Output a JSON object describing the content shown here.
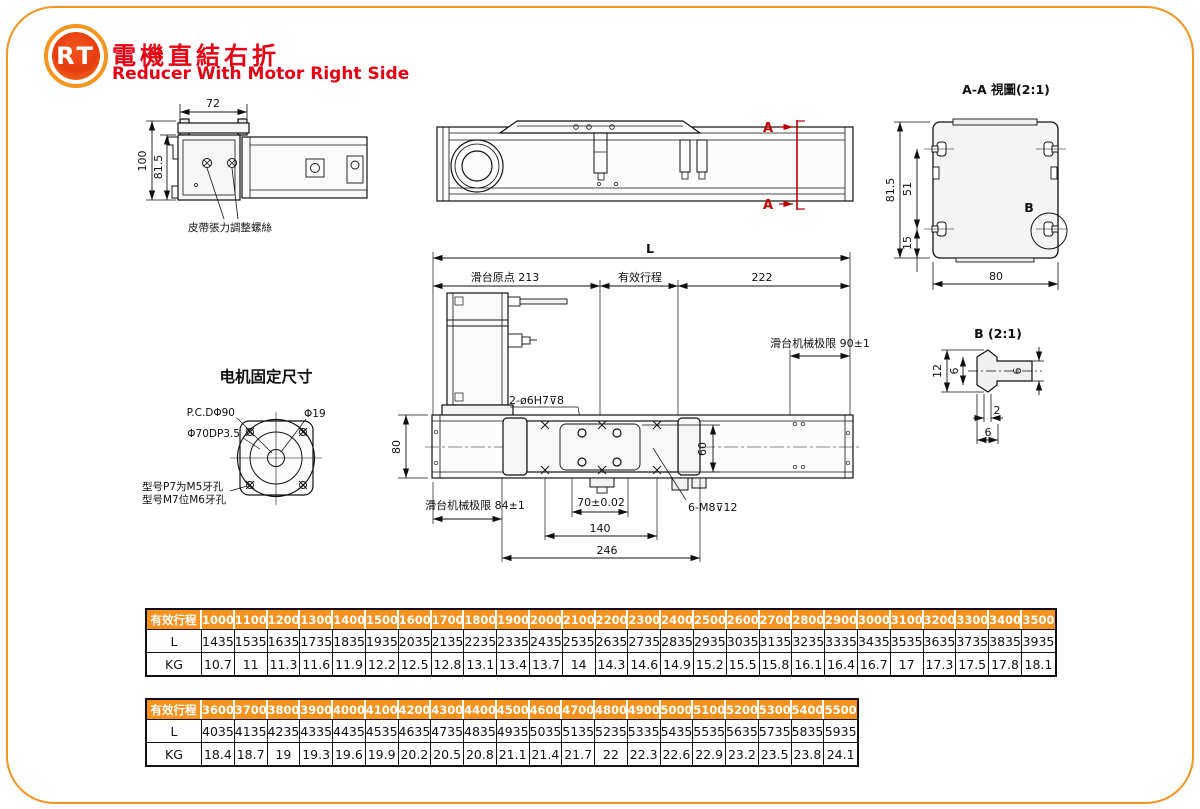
{
  "colors": {
    "accent_orange": "#F6921E",
    "title_red": "#E60012",
    "section_red": "#C00000"
  },
  "header": {
    "logo": "RT",
    "title_zh": "電機直結右折",
    "title_en": "Reducer With Motor Right Side"
  },
  "end_view": {
    "dim_top": "72",
    "dim_total_h": "100",
    "dim_inner_h": "81.5",
    "belt_note": "皮帶張力調整螺絲"
  },
  "top_view": {
    "section_mark_top": "A",
    "section_mark_bottom": "A"
  },
  "section_view": {
    "title": "A-A 視圖(2:1)",
    "dim_h": "81.5",
    "dim_51": "51",
    "dim_15": "15",
    "dim_w": "80",
    "detail_mark": "B"
  },
  "detail_view": {
    "title": "B (2:1)",
    "dim_12": "12",
    "dim_6_left": "6",
    "dim_6_right": "6",
    "dim_2": "2",
    "dim_6_bottom": "6"
  },
  "side_view": {
    "dim_L": "L",
    "origin_label": "滑台原点 213",
    "stroke_label": "有效行程",
    "dim_222": "222",
    "limit_right": "滑台机械极限 90±1",
    "pin_label": "2-ø6H7⊽8",
    "dim_80": "80",
    "dim_60": "60",
    "limit_left": "滑台机械极限 84±1",
    "dim_70": "70±0.02",
    "dim_140": "140",
    "dim_246": "246",
    "screw_label": "6-M8⊽12"
  },
  "motor_mount": {
    "title": "电机固定尺寸",
    "pcd": "P.C.DΦ90",
    "shaft": "Φ19",
    "pilot": "Φ70DP3.5",
    "note1": "型号P7为M5牙孔",
    "note2": "型号M7位M6牙孔"
  },
  "tables": [
    {
      "header_label": "有效行程",
      "strokes": [
        "1000",
        "1100",
        "1200",
        "1300",
        "1400",
        "1500",
        "1600",
        "1700",
        "1800",
        "1900",
        "2000",
        "2100",
        "2200",
        "2300",
        "2400",
        "2500",
        "2600",
        "2700",
        "2800",
        "2900",
        "3000",
        "3100",
        "3200",
        "3300",
        "3400",
        "3500"
      ],
      "rows": [
        {
          "label": "L",
          "values": [
            "1435",
            "1535",
            "1635",
            "1735",
            "1835",
            "1935",
            "2035",
            "2135",
            "2235",
            "2335",
            "2435",
            "2535",
            "2635",
            "2735",
            "2835",
            "2935",
            "3035",
            "3135",
            "3235",
            "3335",
            "3435",
            "3535",
            "3635",
            "3735",
            "3835",
            "3935"
          ]
        },
        {
          "label": "KG",
          "values": [
            "10.7",
            "11",
            "11.3",
            "11.6",
            "11.9",
            "12.2",
            "12.5",
            "12.8",
            "13.1",
            "13.4",
            "13.7",
            "14",
            "14.3",
            "14.6",
            "14.9",
            "15.2",
            "15.5",
            "15.8",
            "16.1",
            "16.4",
            "16.7",
            "17",
            "17.3",
            "17.5",
            "17.8",
            "18.1"
          ]
        }
      ]
    },
    {
      "header_label": "有效行程",
      "strokes": [
        "3600",
        "3700",
        "3800",
        "3900",
        "4000",
        "4100",
        "4200",
        "4300",
        "4400",
        "4500",
        "4600",
        "4700",
        "4800",
        "4900",
        "5000",
        "5100",
        "5200",
        "5300",
        "5400",
        "5500"
      ],
      "rows": [
        {
          "label": "L",
          "values": [
            "4035",
            "4135",
            "4235",
            "4335",
            "4435",
            "4535",
            "4635",
            "4735",
            "4835",
            "4935",
            "5035",
            "5135",
            "5235",
            "5335",
            "5435",
            "5535",
            "5635",
            "5735",
            "5835",
            "5935"
          ]
        },
        {
          "label": "KG",
          "values": [
            "18.4",
            "18.7",
            "19",
            "19.3",
            "19.6",
            "19.9",
            "20.2",
            "20.5",
            "20.8",
            "21.1",
            "21.4",
            "21.7",
            "22",
            "22.3",
            "22.6",
            "22.9",
            "23.2",
            "23.5",
            "23.8",
            "24.1"
          ]
        }
      ]
    }
  ]
}
